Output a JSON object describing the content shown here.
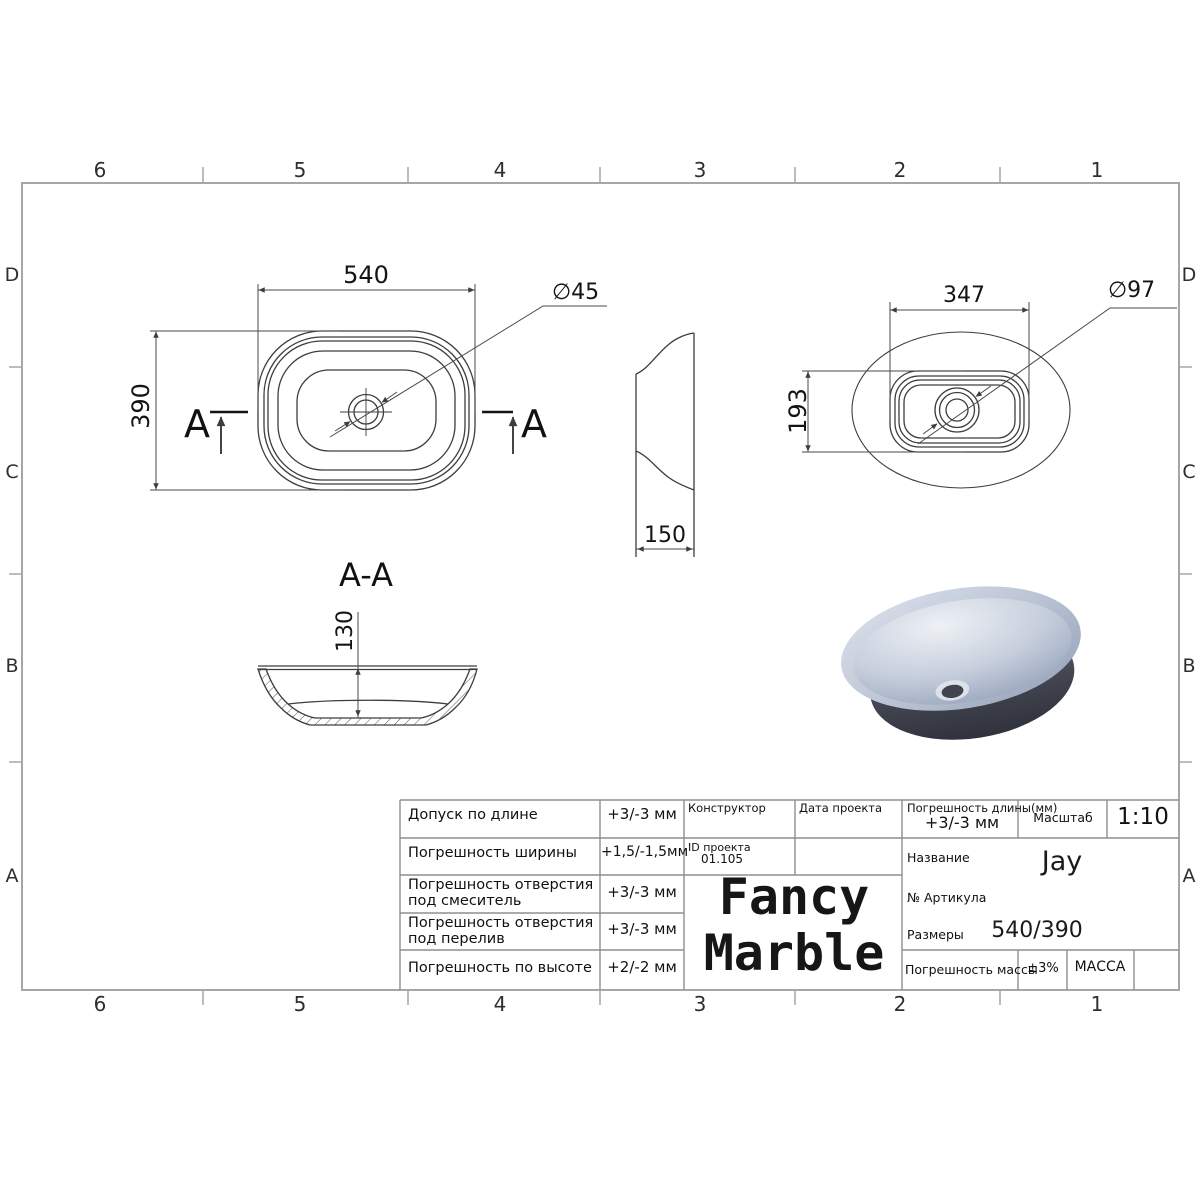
{
  "frame": {
    "zone_cols": [
      "6",
      "5",
      "4",
      "3",
      "2",
      "1"
    ],
    "zone_rows": [
      "D",
      "C",
      "B",
      "A"
    ]
  },
  "views": {
    "plan": {
      "width_dim": "540",
      "height_dim": "390",
      "drain_dim": "∅45",
      "section_letter": "A"
    },
    "side": {
      "width_dim": "150"
    },
    "bottom": {
      "width_dim": "347",
      "height_dim": "193",
      "drain_dim": "∅97"
    },
    "section": {
      "title": "A-A",
      "height_dim": "130"
    }
  },
  "title_block": {
    "tolerances": [
      {
        "label": "Допуск по длине",
        "value": "+3/-3 мм"
      },
      {
        "label": "Погрешность ширины",
        "value": "+1,5/-1,5мм"
      },
      {
        "label": "Погрешность отверстия",
        "label2": "под смеситель",
        "value": "+3/-3 мм"
      },
      {
        "label": "Погрешность отверстия",
        "label2": "под перелив",
        "value": "+3/-3 мм"
      },
      {
        "label": "Погрешность по высоте",
        "value": "+2/-2 мм"
      }
    ],
    "designer_label": "Конструктор",
    "date_label": "Дата проекта",
    "project_id_label": "ID проекта",
    "project_id_value": "01.105",
    "length_tolerance_label": "Погрешность длины(мм)",
    "length_tolerance_value": "+3/-3 мм",
    "scale_label": "Масштаб",
    "scale_value": "1:10",
    "name_label": "Название",
    "name_value": "Jay",
    "article_label": "№ Артикула",
    "size_label": "Размеры",
    "size_value": "540/390",
    "mass_tolerance_label": "Погрешность массы",
    "mass_tolerance_value": "±3%",
    "mass_label": "МАССА",
    "brand_line1": "Fancy",
    "brand_line2": "Marble"
  },
  "colors": {
    "drawing_line": "#3d3d3d",
    "frame_line": "#a6a6a6",
    "table_line": "#8f8f8f",
    "render_rim": "#c9d1df",
    "render_body": "#383b46"
  }
}
